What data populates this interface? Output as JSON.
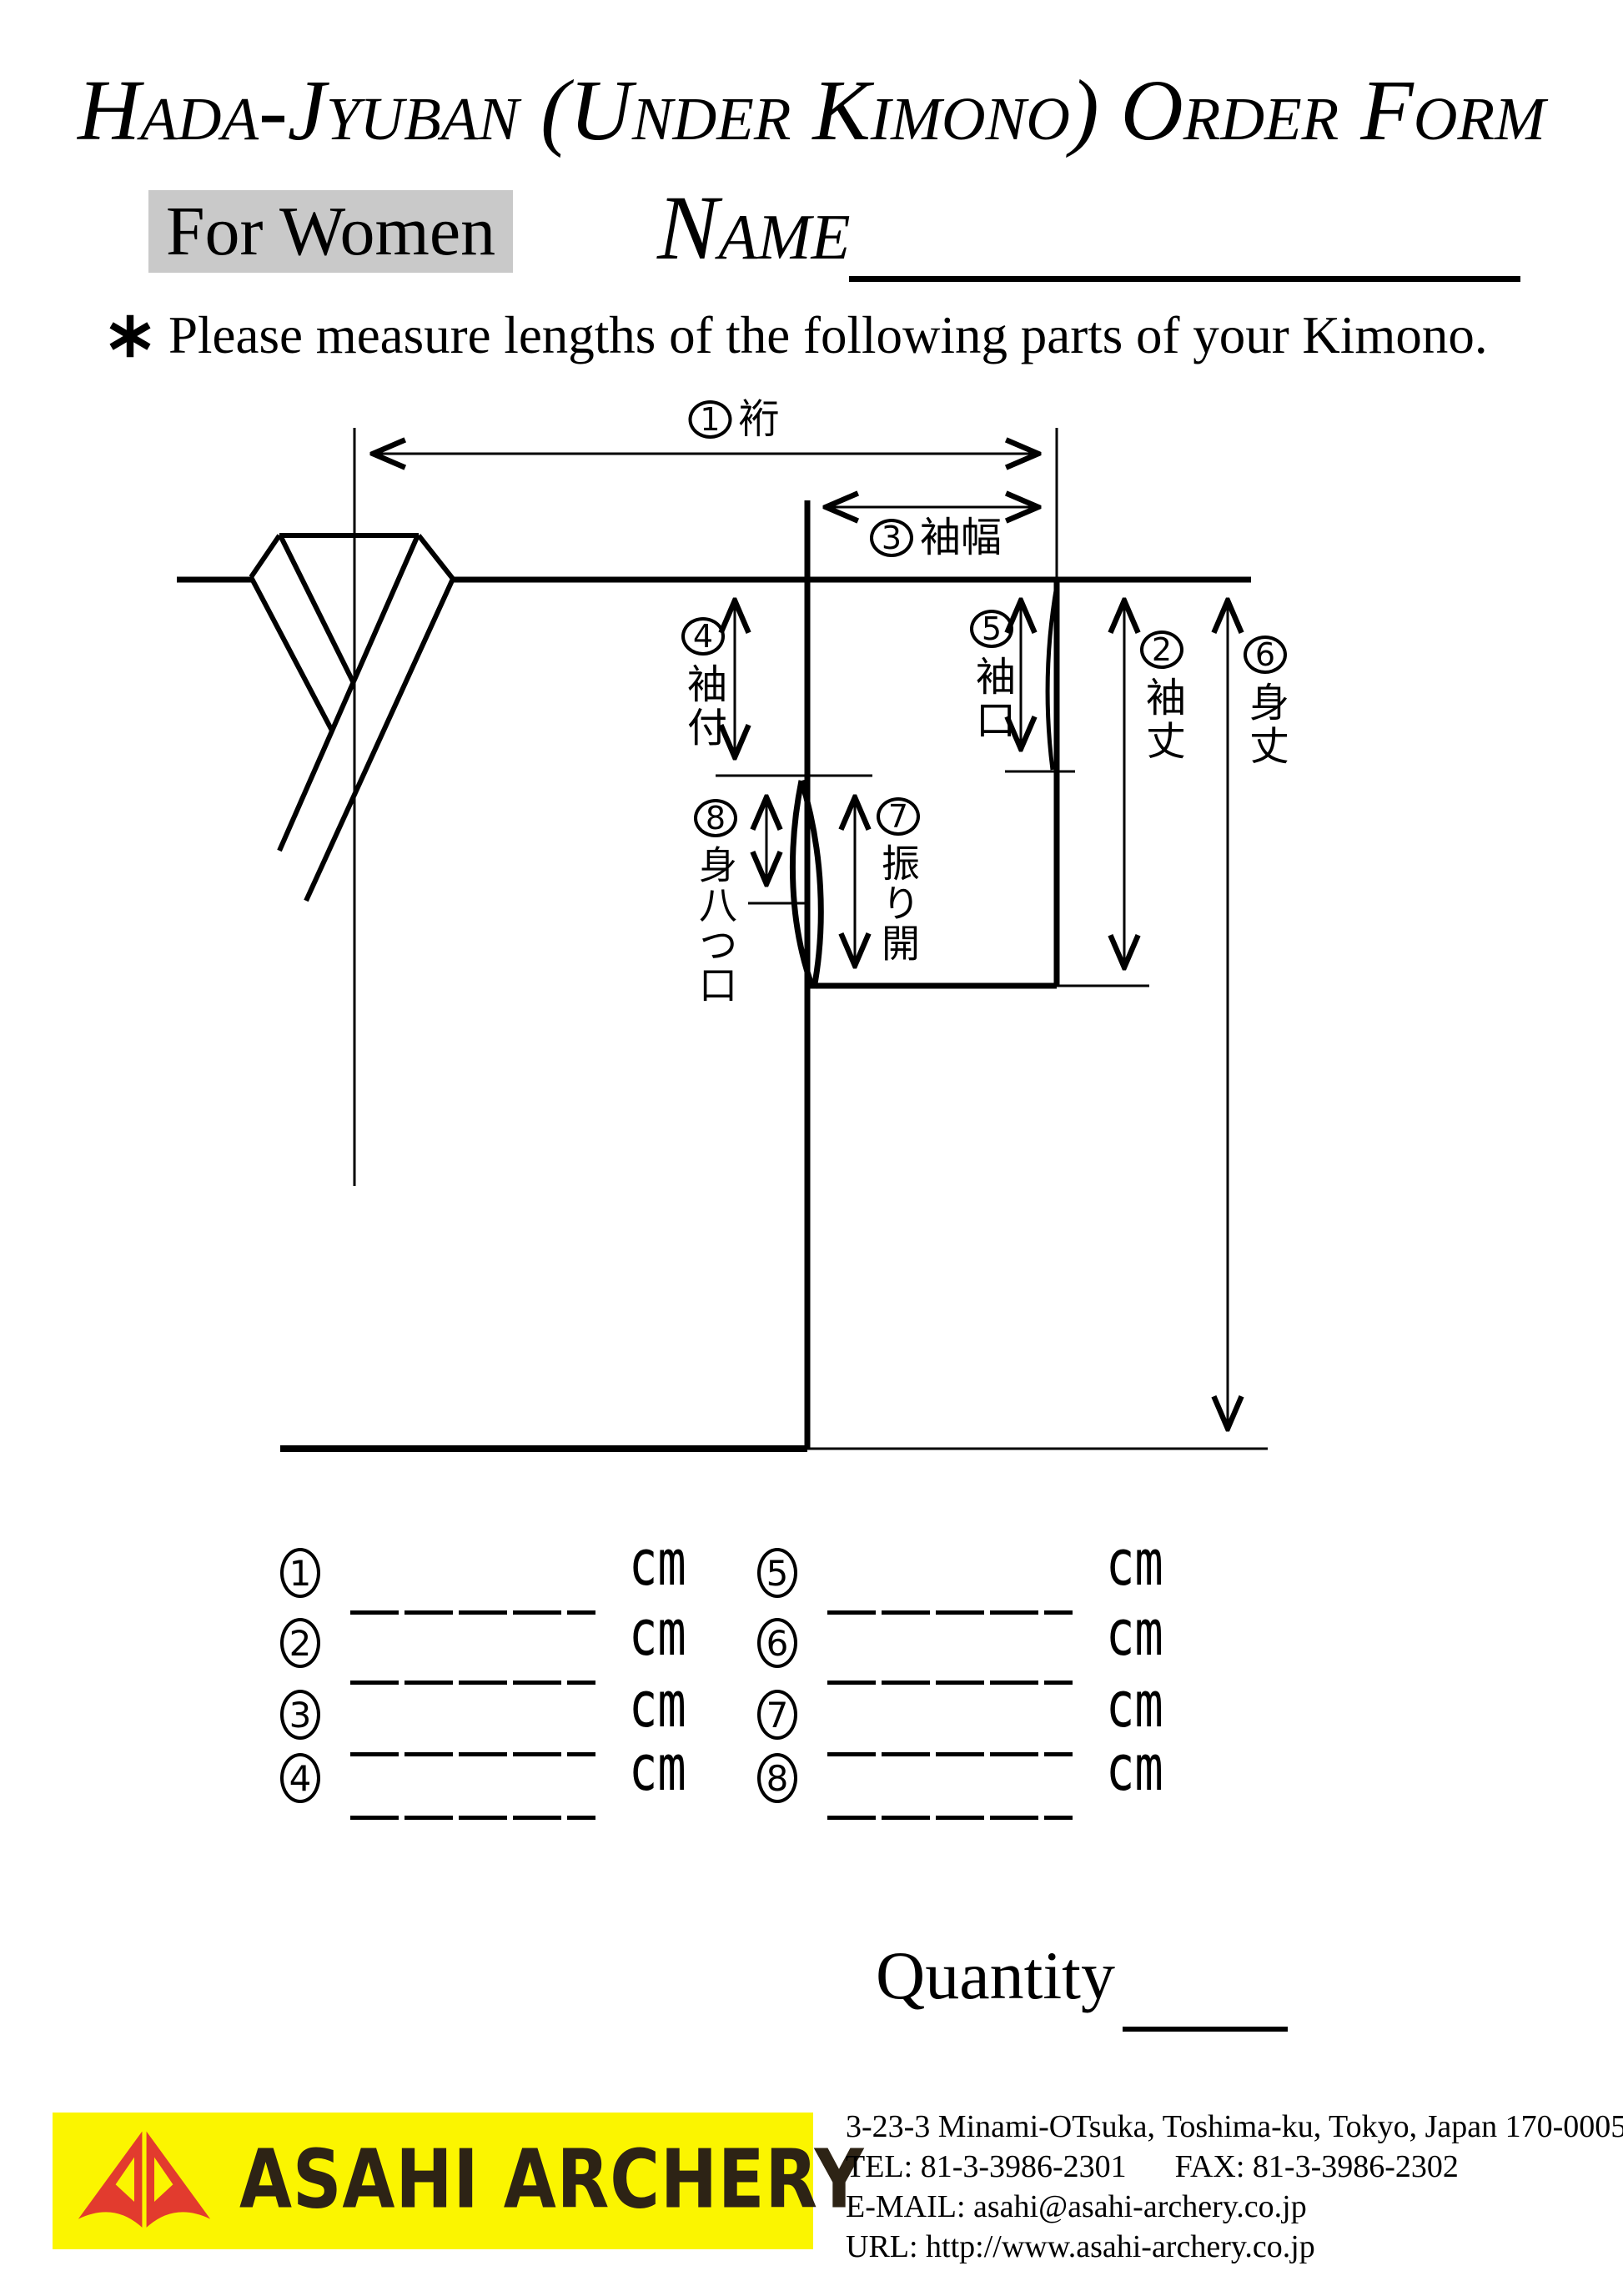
{
  "header": {
    "title": "Hada-Jyuban (Under Kimono) Order Form",
    "audience_label": "For Women",
    "name_label": "Name",
    "note": "Please measure lengths of the following parts of your Kimono."
  },
  "diagram": {
    "labels": {
      "yuki": {
        "num": "1",
        "text": "裄"
      },
      "sodetake": {
        "num": "2",
        "text": "袖丈"
      },
      "sodehaba": {
        "num": "3",
        "text": "袖幅"
      },
      "sodetsuke": {
        "num": "4",
        "text": "袖付"
      },
      "sodeguchi": {
        "num": "5",
        "text": "袖口"
      },
      "mitake": {
        "num": "6",
        "text": "身丈"
      },
      "furiaki": {
        "num": "7",
        "text": "振り開"
      },
      "miyatsuguchi": {
        "num": "8",
        "text": "身八つ口"
      }
    }
  },
  "measurements": {
    "unit": "cm",
    "rows": [
      {
        "num": "1"
      },
      {
        "num": "2"
      },
      {
        "num": "3"
      },
      {
        "num": "4"
      },
      {
        "num": "5"
      },
      {
        "num": "6"
      },
      {
        "num": "7"
      },
      {
        "num": "8"
      }
    ]
  },
  "quantity_label": "Quantity",
  "footer": {
    "logo_text": "ASAHI ARCHERY",
    "address": "3-23-3 Minami-OTsuka, Toshima-ku, Tokyo, Japan 170-0005",
    "tel": "TEL: 81-3-3986-2301",
    "fax": "FAX: 81-3-3986-2302",
    "email": "E-MAIL: asahi@asahi-archery.co.jp",
    "url": "URL: http://www.asahi-archery.co.jp",
    "colors": {
      "logo_bg": "#fbf500",
      "logo_mark_red": "#e23b2e",
      "logo_text_color": "#2d2315",
      "audience_bg": "#c9c9c9"
    }
  }
}
